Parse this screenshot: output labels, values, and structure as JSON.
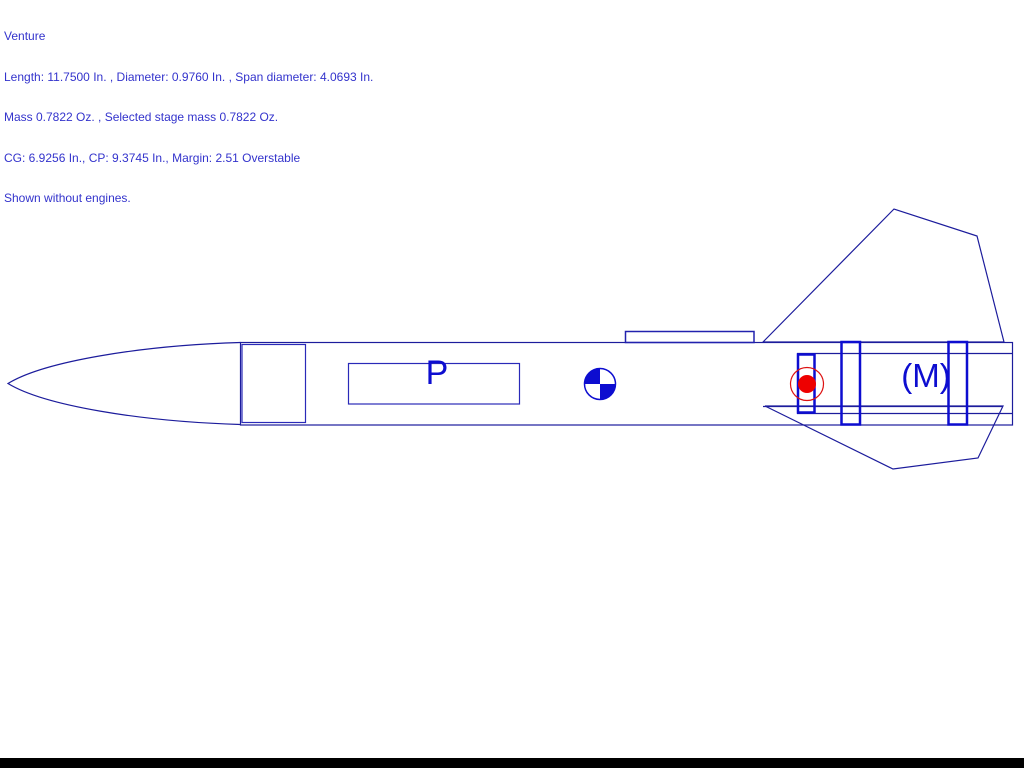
{
  "app": {
    "view": "rocket-design-side-view",
    "background": "#ffffff",
    "bottom_bar_color": "#000000"
  },
  "info_panel": {
    "text_color": "#3333cc",
    "lines": [
      "Venture",
      "Length: 11.7500 In. , Diameter: 0.9760 In. , Span diameter: 4.0693 In.",
      "Mass 0.7822 Oz. , Selected stage mass 0.7822 Oz.",
      "CG: 6.9256 In., CP: 9.3745 In., Margin: 2.51 Overstable",
      "Shown without engines."
    ]
  },
  "rocket": {
    "name": "Venture",
    "length_in": "11.7500",
    "diameter_in": "0.9760",
    "span_diameter_in": "4.0693",
    "mass_oz": "0.7822",
    "selected_stage_mass_oz": "0.7822",
    "cg_in": "6.9256",
    "cp_in": "9.3745",
    "margin": "2.51",
    "stability": "Overstable",
    "engines_note": "Shown without engines.",
    "labels": {
      "parachute": "P",
      "motor_mount": "(M)"
    }
  },
  "colors": {
    "outline": "#1c1c9c",
    "accent": "#0d0dd0",
    "component_blue": "#2a2ab8",
    "cp_red": "#ee0000",
    "cp_ring_red": "#dd1111",
    "cg_blue": "#0d0dd0",
    "info_text": "#3333cc"
  }
}
